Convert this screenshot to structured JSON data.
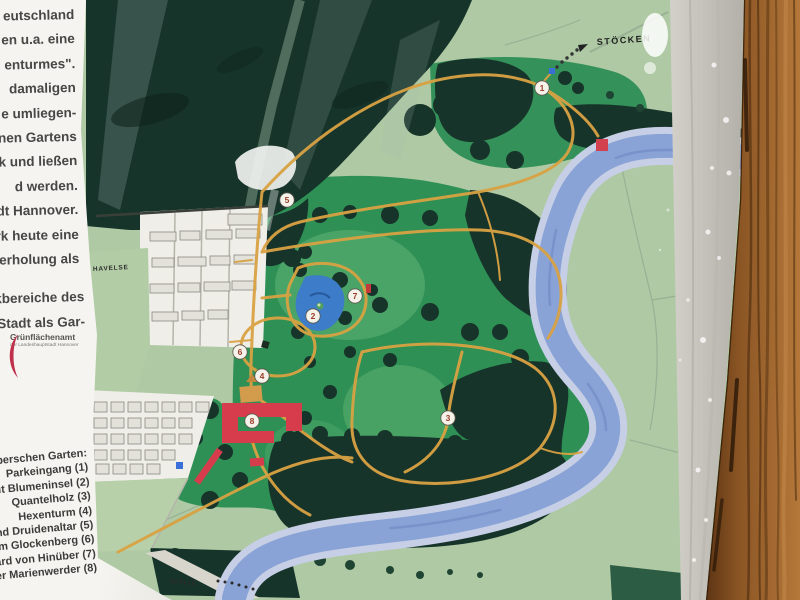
{
  "sign": {
    "paragraph_lines": [
      "eutschland",
      "en u.a. eine",
      "enturmes\".",
      "damaligen",
      "e umliegen-",
      "nen Gartens",
      "k und ließen",
      "d werden.",
      "dt Hannover.",
      "rk heute eine",
      "erholung als"
    ],
    "paragraph2_lines": [
      "kbereiche des",
      "Stadt als Gar-"
    ],
    "logo": {
      "name": "Grünflächenamt",
      "subtitle": "der Landeshauptstadt Hannover"
    },
    "legend": {
      "title": "inüberschen Garten:",
      "items": [
        "Parkeingang (1)",
        "n mit Blumeninsel (2)",
        "Quantelholz (3)",
        "Hexenturm (4)",
        "i und Druidenaltar (5)",
        "dem Glockenberg (6)",
        "erhard von Hinüber (7)",
        "oster Marienwerder (8)"
      ]
    }
  },
  "map": {
    "markers": [
      {
        "n": "1",
        "x": 542,
        "y": 88
      },
      {
        "n": "2",
        "x": 313,
        "y": 316
      },
      {
        "n": "3",
        "x": 448,
        "y": 418
      },
      {
        "n": "4",
        "x": 262,
        "y": 376
      },
      {
        "n": "5",
        "x": 287,
        "y": 200
      },
      {
        "n": "6",
        "x": 240,
        "y": 352
      },
      {
        "n": "7",
        "x": 355,
        "y": 296
      },
      {
        "n": "8",
        "x": 252,
        "y": 421
      }
    ],
    "labels": [
      {
        "text": "STÖCKEN",
        "x": 597,
        "y": 45,
        "size": 9,
        "ls": 1.5,
        "rot": -4,
        "color": "#1e1e1e"
      },
      {
        "text": "HAVELSE",
        "x": 93,
        "y": 271,
        "size": 6.5,
        "ls": 0.8,
        "rot": -3,
        "color": "#2e2e2e"
      },
      {
        "text": "SEELZE",
        "x": 170,
        "y": 583,
        "size": 6,
        "ls": 0.5,
        "rot": 4,
        "color": "#2a2a2a"
      }
    ],
    "colors": {
      "field_pale": "#aec9a3",
      "park_green": "#2f9055",
      "forest_dark": "#17342a",
      "river": "#8aa3d6",
      "river_bank": "#c6cfe6",
      "path_orange": "#d9a243",
      "building_red": "#d63c4c",
      "pond_blue": "#3d7cc8",
      "frame_wood": "#9a6327",
      "frame_gray": "#c9c5c0"
    }
  }
}
